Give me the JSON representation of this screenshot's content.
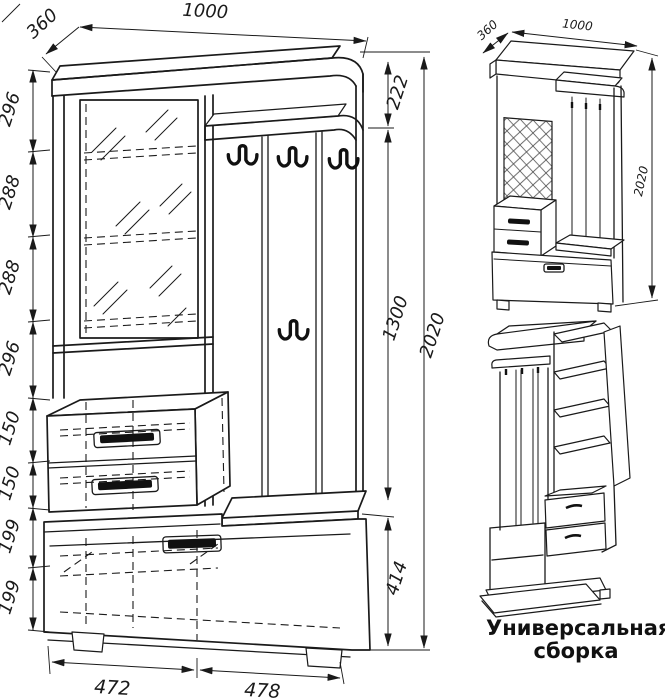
{
  "main_view": {
    "dim_width": "1000",
    "dim_depth": "360",
    "left_chain": [
      "296",
      "288",
      "288",
      "296",
      "150",
      "150",
      "199",
      "199"
    ],
    "dim_top_section": "222",
    "dim_mid_section": "1300",
    "dim_seat_height": "414",
    "dim_total_height": "2020",
    "dim_bottom_left": "472",
    "dim_bottom_right": "478"
  },
  "iso_view": {
    "dim_depth": "360",
    "dim_width": "1000",
    "dim_height": "2020"
  },
  "caption": "Универсальная сборка",
  "colors": {
    "line": "#1a1a1a",
    "background": "#ffffff"
  }
}
